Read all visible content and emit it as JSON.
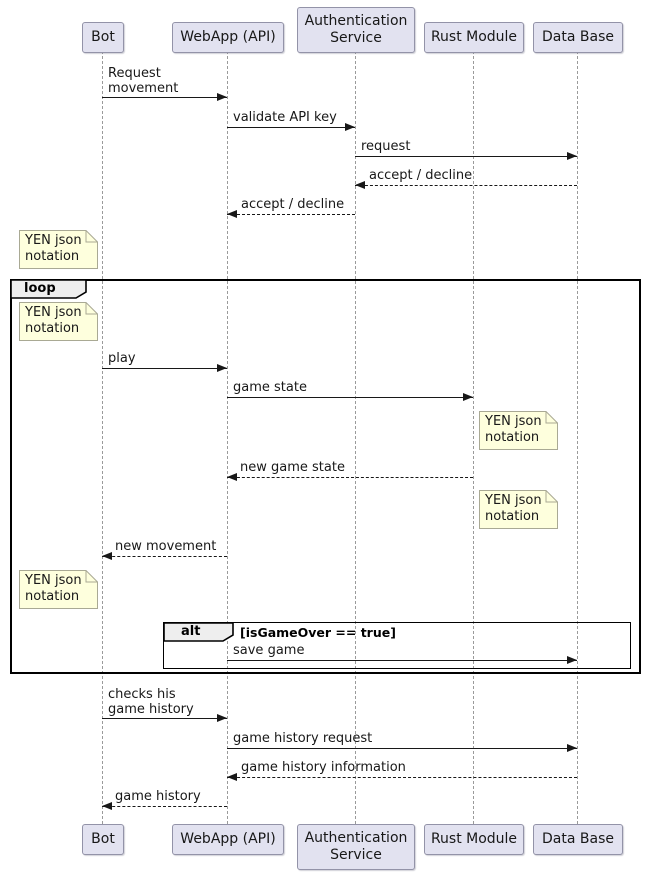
{
  "diagram_type": "uml-sequence-diagram",
  "colors": {
    "participant_fill": "#E2E2F0",
    "participant_border": "#9393A8",
    "note_fill": "#FEFFDD",
    "note_border": "#A9A994",
    "frame_border": "#000000",
    "frame_header_fill": "#EEEEEE",
    "message_line": "#181818",
    "lifeline": "#9A9A9A",
    "background": "#FFFFFF"
  },
  "participants": [
    {
      "label": "Bot"
    },
    {
      "label": "WebApp (API)"
    },
    {
      "label": "Authentication\nService"
    },
    {
      "label": "Rust Module"
    },
    {
      "label": "Data Base"
    }
  ],
  "messages": [
    {
      "label": "Request\nmovement",
      "from": "Bot",
      "to": "WebApp (API)",
      "style": "solid"
    },
    {
      "label": "validate API key",
      "from": "WebApp (API)",
      "to": "Authentication Service",
      "style": "solid"
    },
    {
      "label": "request",
      "from": "Authentication Service",
      "to": "Data Base",
      "style": "solid"
    },
    {
      "label": "accept / decline",
      "from": "Data Base",
      "to": "Authentication Service",
      "style": "dashed"
    },
    {
      "label": "accept / decline",
      "from": "Authentication Service",
      "to": "WebApp (API)",
      "style": "dashed"
    },
    {
      "label": "play",
      "from": "Bot",
      "to": "WebApp (API)",
      "style": "solid"
    },
    {
      "label": "game state",
      "from": "WebApp (API)",
      "to": "Rust Module",
      "style": "solid"
    },
    {
      "label": "new game state",
      "from": "Rust Module",
      "to": "WebApp (API)",
      "style": "dashed"
    },
    {
      "label": "new movement",
      "from": "WebApp (API)",
      "to": "Bot",
      "style": "dashed"
    },
    {
      "label": "save game",
      "from": "WebApp (API)",
      "to": "Data Base",
      "style": "solid"
    },
    {
      "label": "checks his\ngame history",
      "from": "Bot",
      "to": "WebApp (API)",
      "style": "solid"
    },
    {
      "label": "game history request",
      "from": "WebApp (API)",
      "to": "Data Base",
      "style": "solid"
    },
    {
      "label": "game history information",
      "from": "Data Base",
      "to": "WebApp (API)",
      "style": "dashed"
    },
    {
      "label": "game history",
      "from": "WebApp (API)",
      "to": "Bot",
      "style": "dashed"
    }
  ],
  "notes": [
    {
      "label": "YEN json\nnotation"
    },
    {
      "label": "YEN json\nnotation"
    },
    {
      "label": "YEN json\nnotation"
    },
    {
      "label": "YEN json\nnotation"
    },
    {
      "label": "YEN json\nnotation"
    }
  ],
  "frames": {
    "loop": {
      "label": "loop",
      "guard": ""
    },
    "alt": {
      "label": "alt",
      "guard": "[isGameOver == true]"
    }
  }
}
